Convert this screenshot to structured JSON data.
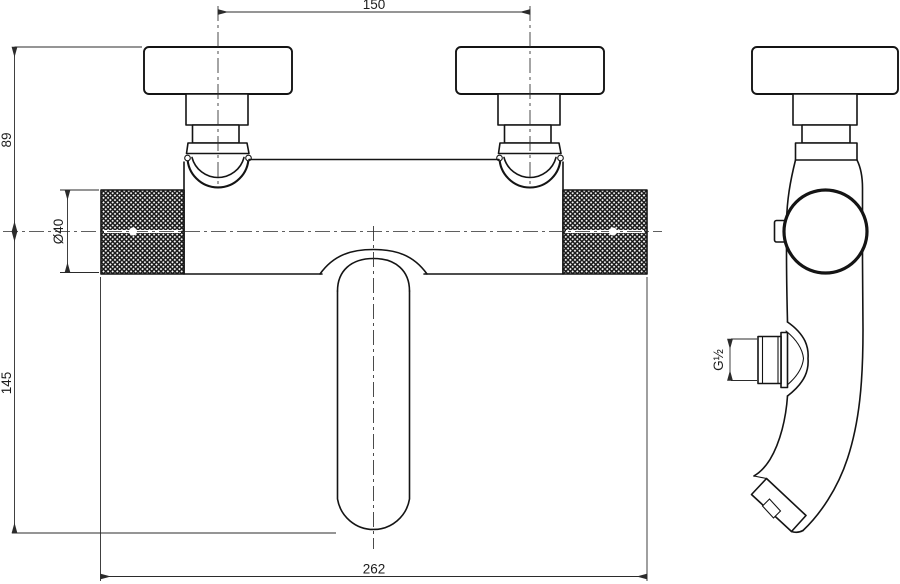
{
  "drawing": {
    "dimensions": {
      "mount_spacing": "150",
      "wall_to_center": "89",
      "body_diameter": "Ø40",
      "center_to_spout_outlet": "145",
      "overall_width": "262",
      "shower_outlet_thread": "G½"
    },
    "colors": {
      "line": "#141414",
      "dimension": "#2b2b2b",
      "background": "#ffffff"
    }
  }
}
